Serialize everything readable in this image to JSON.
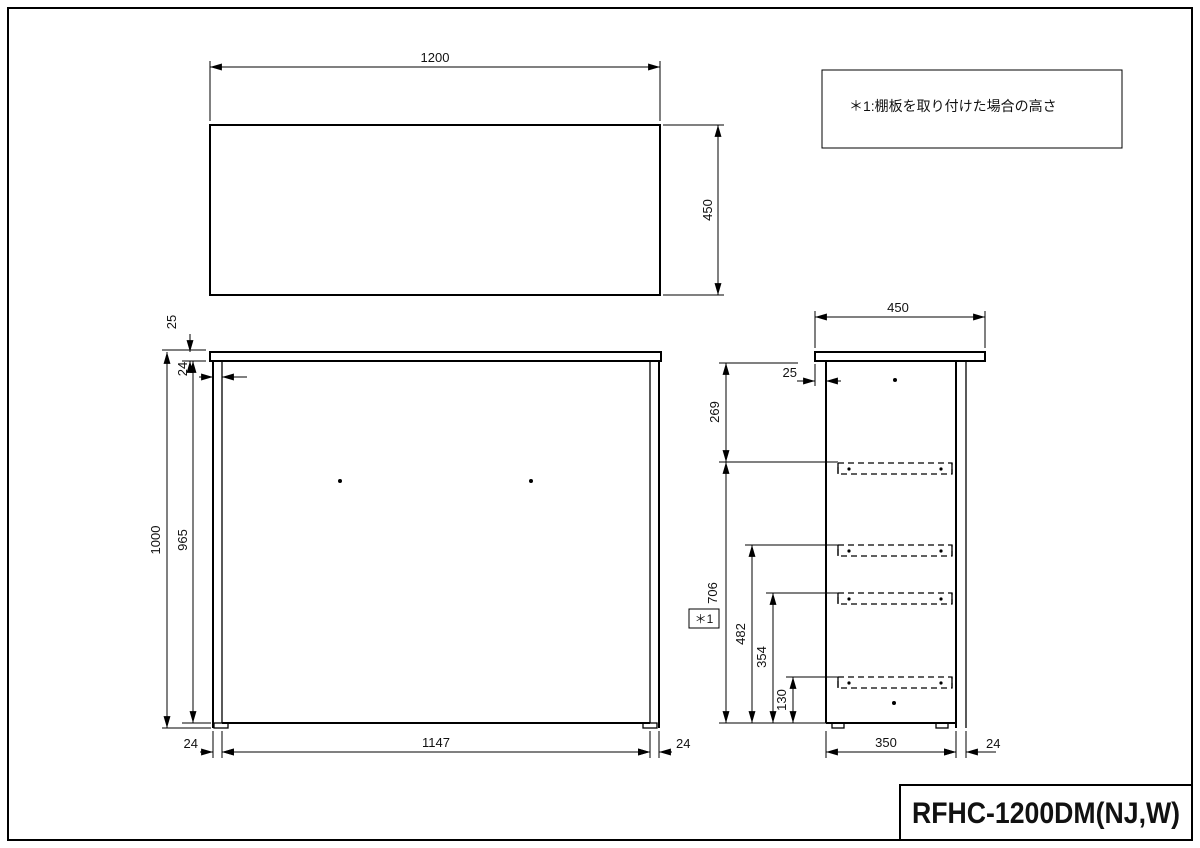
{
  "title_block": {
    "model": "RFHC-1200DM(NJ,W)"
  },
  "note_box": {
    "text": "＊1:棚板を取り付けた場合の高さ"
  },
  "top_view": {
    "width": "1200",
    "depth": "450"
  },
  "front_view": {
    "top_thickness": "25",
    "side_panel_top": "24",
    "height": "1000",
    "inner_height": "965",
    "inner_width": "1147",
    "side_panel_left": "24",
    "side_panel_right": "24"
  },
  "side_view": {
    "top_depth": "450",
    "front_setback": "25",
    "top_to_shelf": "269",
    "shelf_marker": "＊1",
    "shelf_height_1": "706",
    "shelf_height_2": "482",
    "shelf_height_3": "354",
    "shelf_height_4": "130",
    "body_depth": "350",
    "back_panel": "24"
  }
}
